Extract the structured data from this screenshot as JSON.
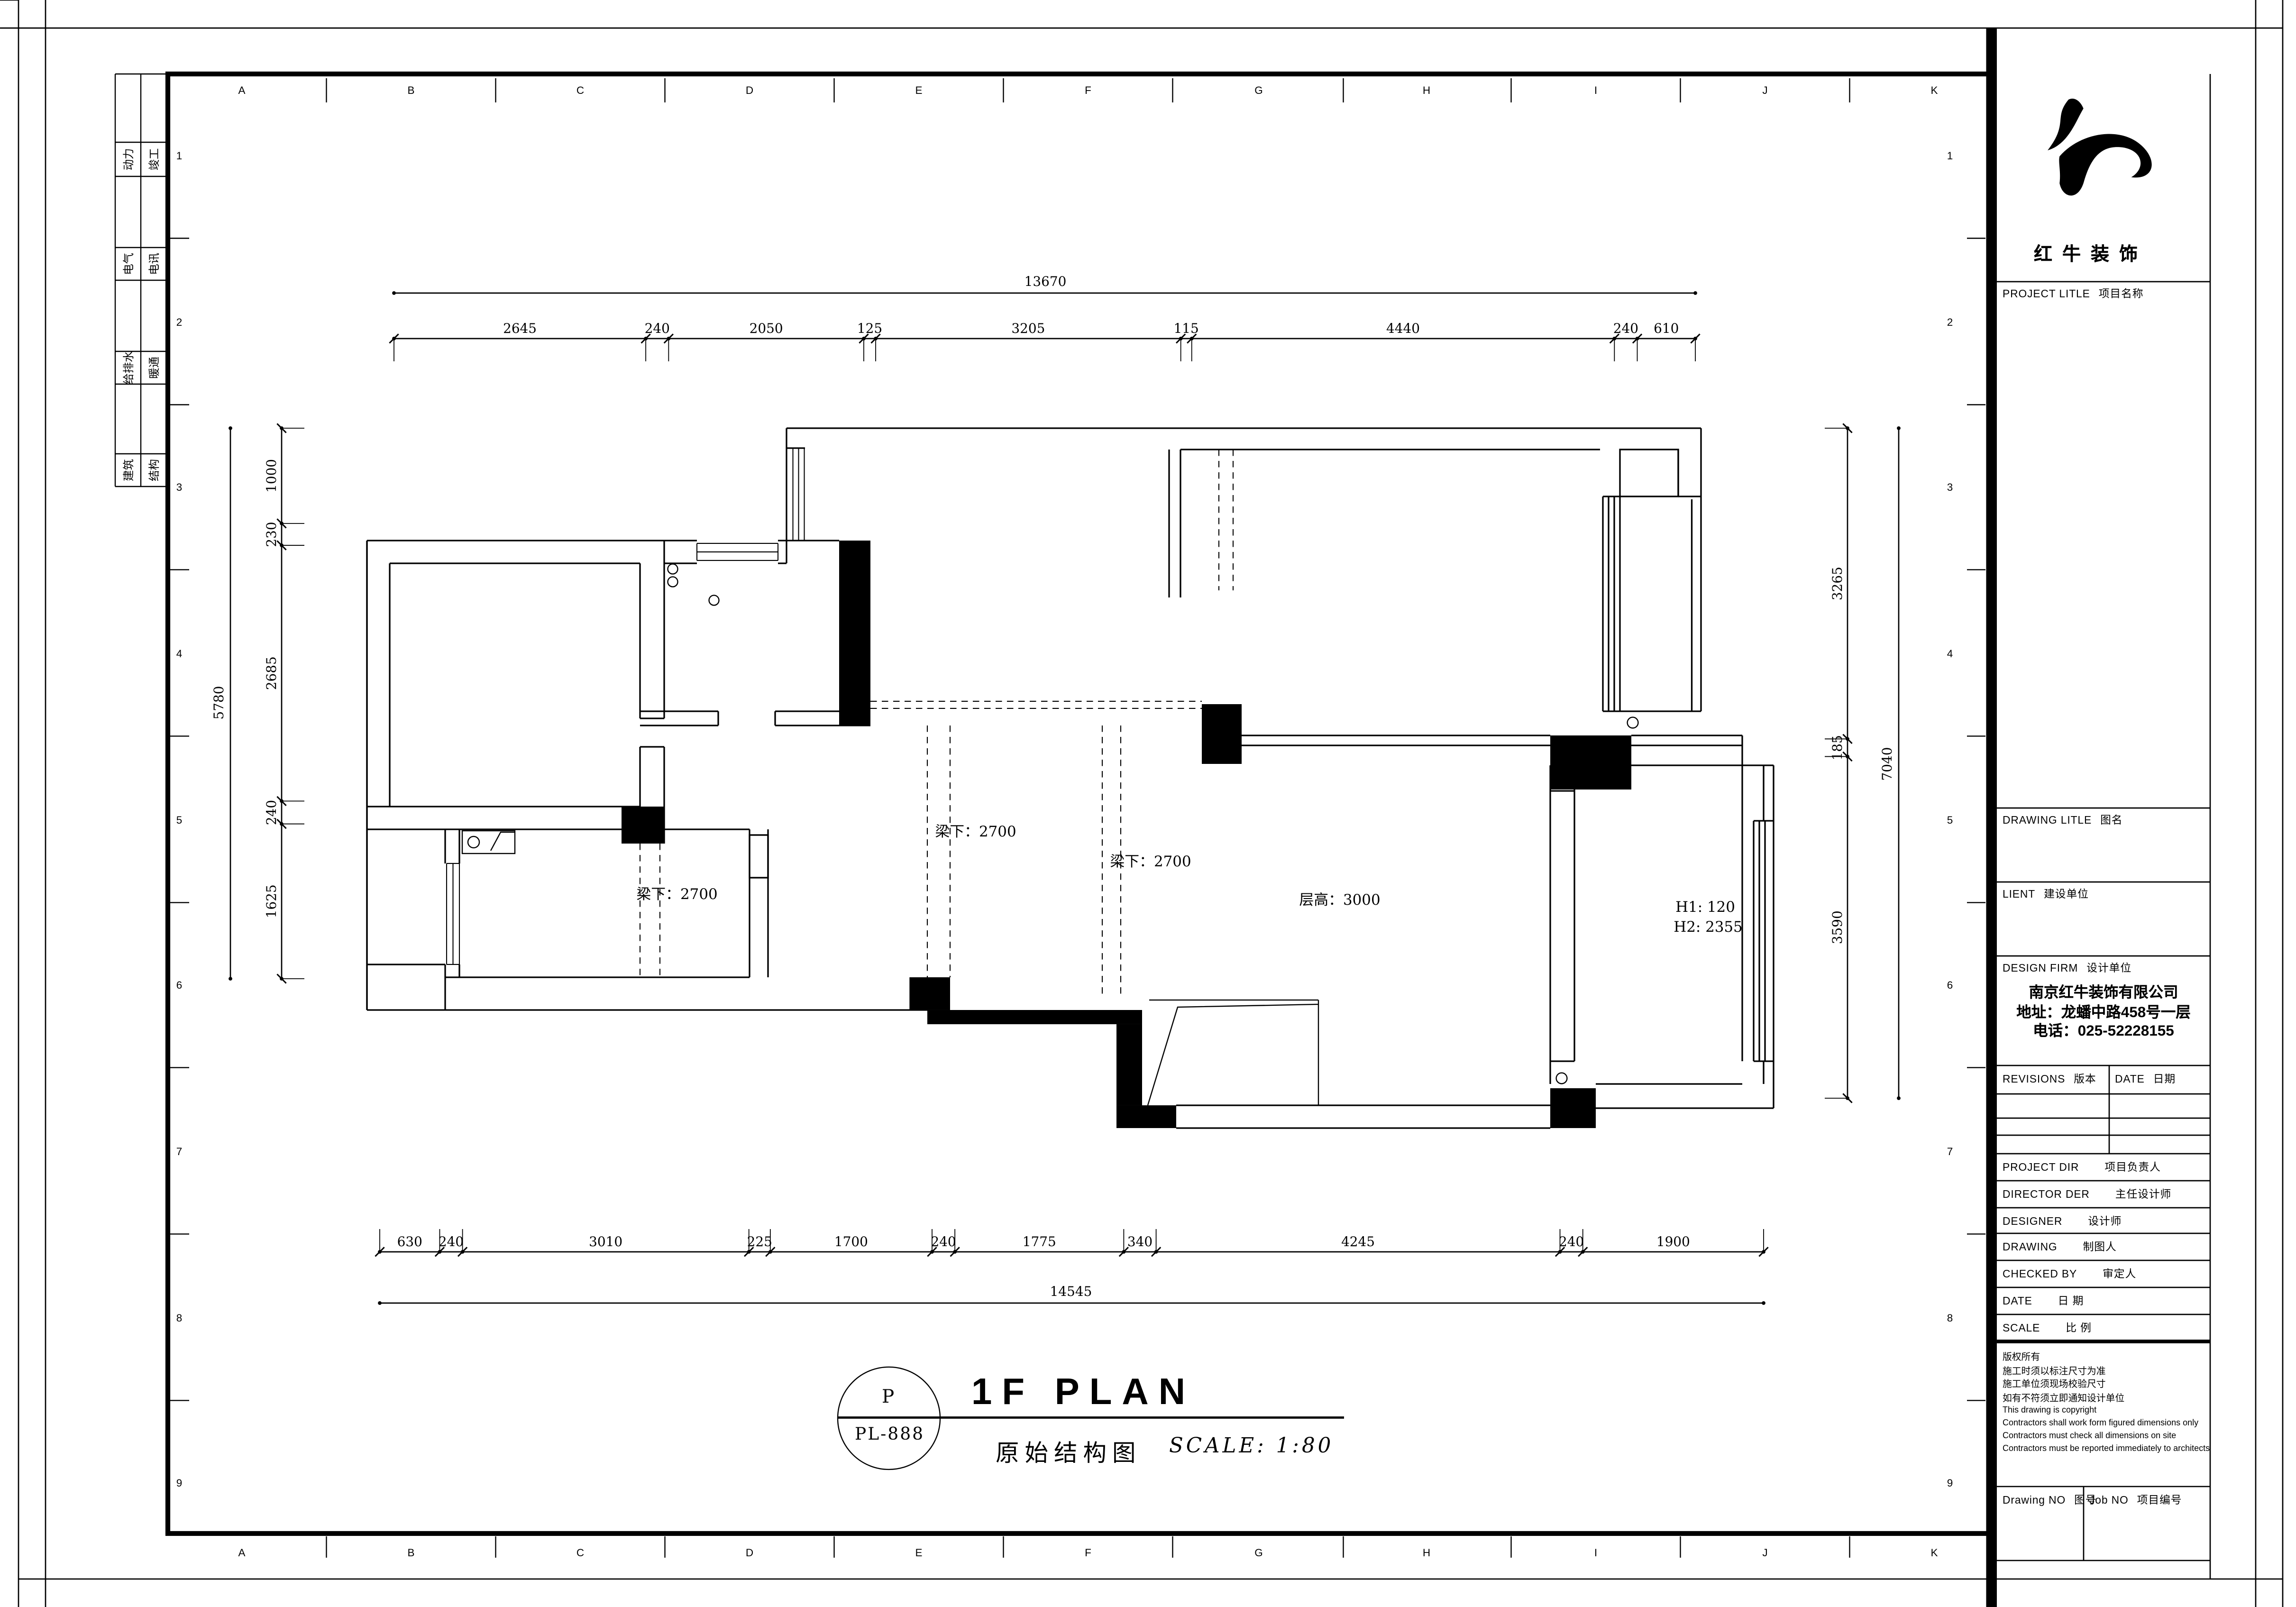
{
  "logo": {
    "name": "红牛装饰"
  },
  "sheet": {
    "grid_letters": [
      "A",
      "B",
      "C",
      "D",
      "E",
      "F",
      "G",
      "H",
      "I",
      "J",
      "K"
    ],
    "grid_numbers": [
      "1",
      "2",
      "3",
      "4",
      "5",
      "6",
      "7",
      "8",
      "9"
    ]
  },
  "disciplines": {
    "rows": [
      [
        "动力",
        "竣工"
      ],
      [
        "电气",
        "电讯"
      ],
      [
        "给排水",
        "暖通"
      ],
      [
        "建筑",
        "结构"
      ]
    ]
  },
  "plan": {
    "dimensions": {
      "top": {
        "total": "13670",
        "segments": [
          "2645",
          "240",
          "2050",
          "125",
          "3205",
          "115",
          "4440",
          "240",
          "610"
        ]
      },
      "bottom": {
        "total": "14545",
        "segments": [
          "630",
          "240",
          "3010",
          "225",
          "1700",
          "240",
          "1775",
          "340",
          "4245",
          "240",
          "1900"
        ]
      },
      "left": {
        "total": "5780",
        "segments": [
          "1000",
          "230",
          "2685",
          "240",
          "1625"
        ]
      },
      "right": {
        "total": "7040",
        "segments": [
          "3265",
          "185",
          "3590"
        ]
      }
    },
    "annotations": [
      {
        "id": "beam-left",
        "text": "梁下：2700"
      },
      {
        "id": "beam-mid",
        "text": "梁下：2700"
      },
      {
        "id": "beam-right",
        "text": "梁下：2700"
      },
      {
        "id": "floor-height",
        "text": "层高：3000"
      },
      {
        "id": "h1",
        "text": "H1: 120"
      },
      {
        "id": "h2",
        "text": "H2: 2355"
      }
    ]
  },
  "title_area": {
    "stamp_top": "P",
    "stamp_bottom": "PL-888",
    "title": "1F PLAN",
    "subtitle": "原始结构图",
    "scale": "SCALE: 1:80"
  },
  "title_block": {
    "project_label": {
      "en": "PROJECT LITLE",
      "zh": "项目名称"
    },
    "drawing_label": {
      "en": "DRAWING LITLE",
      "zh": "图名"
    },
    "client_label": {
      "en": "LIENT",
      "zh": "建设单位"
    },
    "firm_label": {
      "en": "DESIGN FIRM",
      "zh": "设计单位"
    },
    "company": [
      "南京红牛装饰有限公司",
      "地址：龙蟠中路458号一层",
      "电话：025-52228155"
    ],
    "revisions_label": {
      "en": "REVISIONS",
      "zh": "版本"
    },
    "date_col_label": {
      "en": "DATE",
      "zh": "日期"
    },
    "rows": [
      {
        "en": "PROJECT DIR",
        "zh": "项目负责人"
      },
      {
        "en": "DIRECTOR DER",
        "zh": "主任设计师"
      },
      {
        "en": "DESIGNER",
        "zh": "设计师"
      },
      {
        "en": "DRAWING",
        "zh": "制图人"
      },
      {
        "en": "CHECKED BY",
        "zh": "审定人"
      },
      {
        "en": "DATE",
        "zh": "日  期"
      },
      {
        "en": "SCALE",
        "zh": "比  例"
      }
    ],
    "notes": [
      "版权所有",
      "施工时须以标注尺寸为准",
      "施工单位须现场校验尺寸",
      "如有不符须立即通知设计单位",
      "This drawing is copyright",
      "Contractors shall work form figured dimensions only",
      "Contractors must check all dimensions on site",
      "Contractors must be reported immediately to architects"
    ],
    "drawing_no_label": {
      "en": "Drawing NO",
      "zh": "图号"
    },
    "job_no_label": {
      "en": "Job NO",
      "zh": "项目编号"
    }
  }
}
